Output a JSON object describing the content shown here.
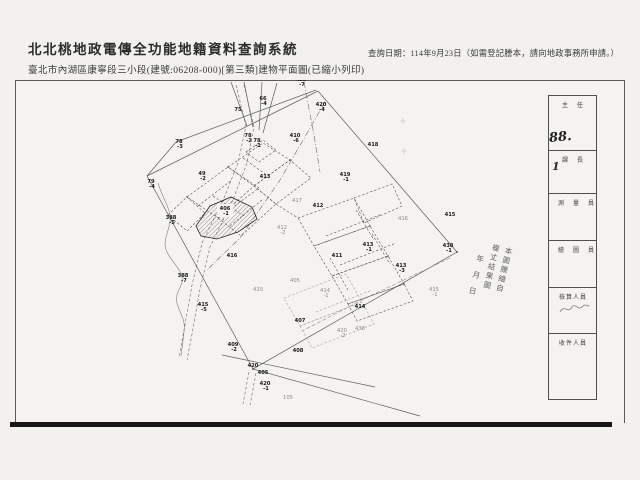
{
  "header": {
    "system_title": "北北桃地政電傳全功能地籍資料查詢系統",
    "document_title": "臺北市內湖區康寧段三小段(建號:06208-000)[第三類]建物平面圖(已縮小列印)",
    "query_date_note": "查詢日期：114年9月23日（如需登記謄本，請向地政事務所申請。）"
  },
  "stamp_strip": {
    "rows": [
      {
        "label": "主任"
      },
      {
        "label": "課長"
      },
      {
        "label": "測量員"
      },
      {
        "label": "繪圖員"
      },
      {
        "label": "檢算人員"
      },
      {
        "label": "收件人員"
      }
    ],
    "handwritten_number": "88.",
    "handwritten_mark": "1"
  },
  "map": {
    "copy_stamp_lines": [
      "本圖謄繪自",
      "複丈結果圖",
      "年月日"
    ],
    "subject_parcel": "406-1",
    "labels": [
      {
        "x": 301,
        "y": 81,
        "text": "422",
        "suffix": "-7",
        "tone": "dark"
      },
      {
        "x": 263,
        "y": 100,
        "text": "66",
        "suffix": "-4",
        "tone": "dark"
      },
      {
        "x": 238,
        "y": 111,
        "text": "75",
        "suffix": "",
        "tone": "dark"
      },
      {
        "x": 321,
        "y": 106,
        "text": "420",
        "suffix": "-4",
        "tone": "dark"
      },
      {
        "x": 295,
        "y": 137,
        "text": "410",
        "suffix": "-6",
        "tone": "dark"
      },
      {
        "x": 373,
        "y": 146,
        "text": "418",
        "suffix": "",
        "tone": "dark"
      },
      {
        "x": 179,
        "y": 143,
        "text": "78",
        "suffix": "-3",
        "tone": "dark"
      },
      {
        "x": 248,
        "y": 137,
        "text": "78",
        "suffix": "-2",
        "tone": "dark"
      },
      {
        "x": 257,
        "y": 142,
        "text": "78",
        "suffix": "-1",
        "tone": "dark"
      },
      {
        "x": 151,
        "y": 183,
        "text": "79",
        "suffix": "-4",
        "tone": "dark"
      },
      {
        "x": 202,
        "y": 175,
        "text": "49",
        "suffix": "-2",
        "tone": "dark"
      },
      {
        "x": 265,
        "y": 178,
        "text": "413",
        "suffix": "",
        "tone": "dark"
      },
      {
        "x": 345,
        "y": 176,
        "text": "419",
        "suffix": "-1",
        "tone": "dark"
      },
      {
        "x": 297,
        "y": 202,
        "text": "417",
        "suffix": "",
        "tone": "gray"
      },
      {
        "x": 318,
        "y": 207,
        "text": "412",
        "suffix": "",
        "tone": "dark"
      },
      {
        "x": 282,
        "y": 229,
        "text": "412",
        "suffix": "-2",
        "tone": "gray"
      },
      {
        "x": 337,
        "y": 257,
        "text": "411",
        "suffix": "",
        "tone": "dark"
      },
      {
        "x": 368,
        "y": 246,
        "text": "413",
        "suffix": "-1",
        "tone": "dark"
      },
      {
        "x": 401,
        "y": 267,
        "text": "413",
        "suffix": "-3",
        "tone": "dark"
      },
      {
        "x": 450,
        "y": 216,
        "text": "415",
        "suffix": "",
        "tone": "dark"
      },
      {
        "x": 403,
        "y": 220,
        "text": "416",
        "suffix": "",
        "tone": "gray"
      },
      {
        "x": 171,
        "y": 219,
        "text": "388",
        "suffix": "-5",
        "tone": "dark"
      },
      {
        "x": 183,
        "y": 277,
        "text": "388",
        "suffix": "-7",
        "tone": "dark"
      },
      {
        "x": 203,
        "y": 306,
        "text": "415",
        "suffix": "-5",
        "tone": "dark"
      },
      {
        "x": 233,
        "y": 346,
        "text": "409",
        "suffix": "-2",
        "tone": "dark"
      },
      {
        "x": 232,
        "y": 257,
        "text": "416",
        "suffix": "",
        "tone": "dark"
      },
      {
        "x": 258,
        "y": 291,
        "text": "420",
        "suffix": "",
        "tone": "gray"
      },
      {
        "x": 295,
        "y": 282,
        "text": "405",
        "suffix": "",
        "tone": "gray"
      },
      {
        "x": 325,
        "y": 292,
        "text": "414",
        "suffix": "-1",
        "tone": "gray"
      },
      {
        "x": 360,
        "y": 308,
        "text": "414",
        "suffix": "",
        "tone": "dark"
      },
      {
        "x": 300,
        "y": 322,
        "text": "407",
        "suffix": "",
        "tone": "dark"
      },
      {
        "x": 434,
        "y": 291,
        "text": "415",
        "suffix": "-1",
        "tone": "gray"
      },
      {
        "x": 342,
        "y": 332,
        "text": "420",
        "suffix": "-2",
        "tone": "gray"
      },
      {
        "x": 360,
        "y": 330,
        "text": "438",
        "suffix": "",
        "tone": "gray"
      },
      {
        "x": 298,
        "y": 352,
        "text": "408",
        "suffix": "",
        "tone": "dark"
      },
      {
        "x": 253,
        "y": 367,
        "text": "420",
        "suffix": "",
        "tone": "dark"
      },
      {
        "x": 263,
        "y": 374,
        "text": "405",
        "suffix": "",
        "tone": "dark"
      },
      {
        "x": 265,
        "y": 385,
        "text": "420",
        "suffix": "-1",
        "tone": "dark"
      },
      {
        "x": 288,
        "y": 399,
        "text": "105",
        "suffix": "",
        "tone": "gray"
      },
      {
        "x": 448,
        "y": 247,
        "text": "438",
        "suffix": "-1",
        "tone": "dark"
      },
      {
        "x": 225,
        "y": 210,
        "text": "406",
        "suffix": "-1",
        "tone": "dark",
        "halo": true
      }
    ]
  }
}
